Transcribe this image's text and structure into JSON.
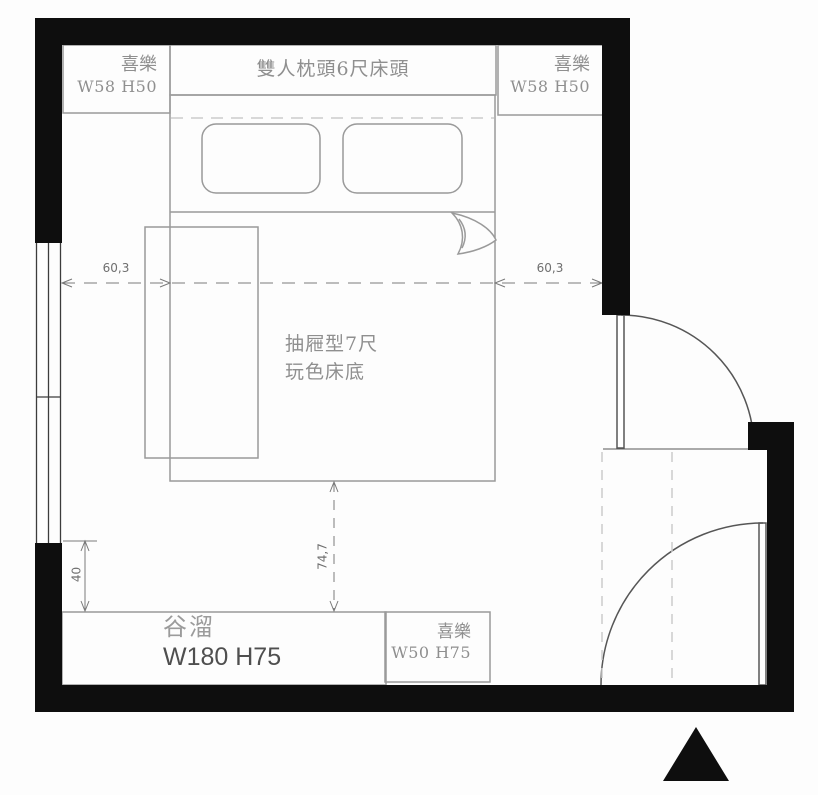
{
  "title": "bedroom-floor-plan",
  "colors": {
    "wall": "#0e0e0e",
    "furniture_line": "#9a9a9a",
    "door_line": "#565656",
    "dim_line": "#7a7a7a",
    "dim_text": "#6f6f6f",
    "text_gray": "#8f8f8f",
    "dashed_light": "#cccccc",
    "desk_size_text": "#4f4f4f"
  },
  "plan": {
    "headboard": {
      "label": "雙人枕頭6尺床頭"
    },
    "nightstand_top_left": {
      "name": "喜樂",
      "size": "W58 H50"
    },
    "nightstand_top_right": {
      "name": "喜樂",
      "size": "W58 H50"
    },
    "bed_base": {
      "line1": "抽屜型7尺",
      "line2": "玩色床底"
    },
    "desk": {
      "name": "谷溜",
      "size": "W180 H75"
    },
    "nightstand_bottom_right": {
      "name": "喜樂",
      "size": "W50 H75"
    },
    "dimensions": {
      "left_gap": "60,3",
      "right_gap": "60,3",
      "bed_to_desk": "74,7",
      "wall_to_desk": "40"
    }
  },
  "icons": {
    "north_arrow": "solid black triangle pointing up"
  }
}
